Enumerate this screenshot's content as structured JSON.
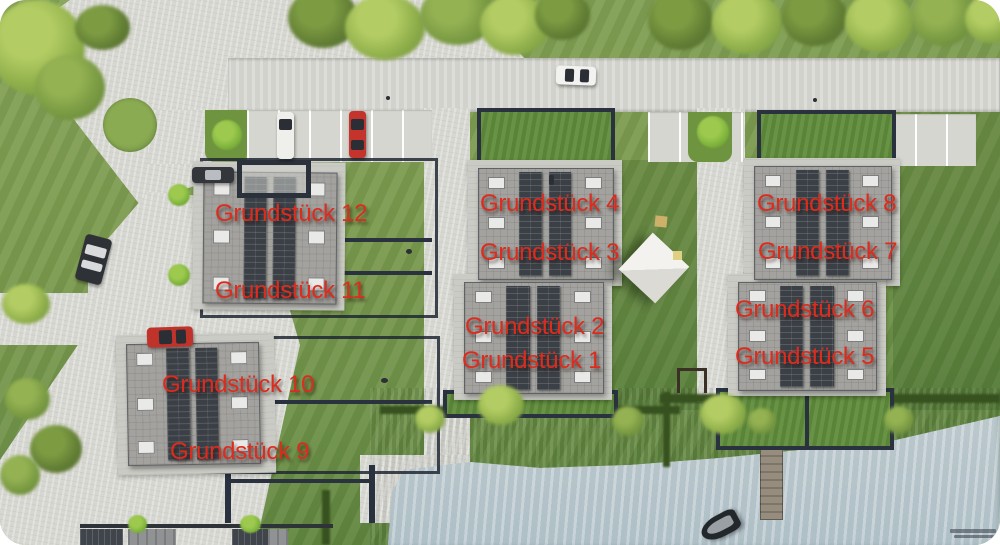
{
  "plots": [
    {
      "id": 1,
      "label": "Grundstück 1"
    },
    {
      "id": 2,
      "label": "Grundstück 2"
    },
    {
      "id": 3,
      "label": "Grundstück 3"
    },
    {
      "id": 4,
      "label": "Grundstück 4"
    },
    {
      "id": 5,
      "label": "Grundstück 5"
    },
    {
      "id": 6,
      "label": "Grundstück 6"
    },
    {
      "id": 7,
      "label": "Grundstück 7"
    },
    {
      "id": 8,
      "label": "Grundstück 8"
    },
    {
      "id": 9,
      "label": "Grundstück 9"
    },
    {
      "id": 10,
      "label": "Grundstück 10"
    },
    {
      "id": 11,
      "label": "Grundstück 11"
    },
    {
      "id": 12,
      "label": "Grundstück 12"
    }
  ],
  "colors": {
    "label_red": "#de2b1d",
    "grass_green": "#7b9a4e",
    "road_gray": "#d6d6d0",
    "water_blue": "#b6c5c9",
    "roof_gray": "#a3a29e",
    "solar_panel_dark": "#3b4046",
    "plot_border_navy": "#2a3240",
    "tree_light_green": "#9cb654",
    "car_red": "#c0332b"
  }
}
